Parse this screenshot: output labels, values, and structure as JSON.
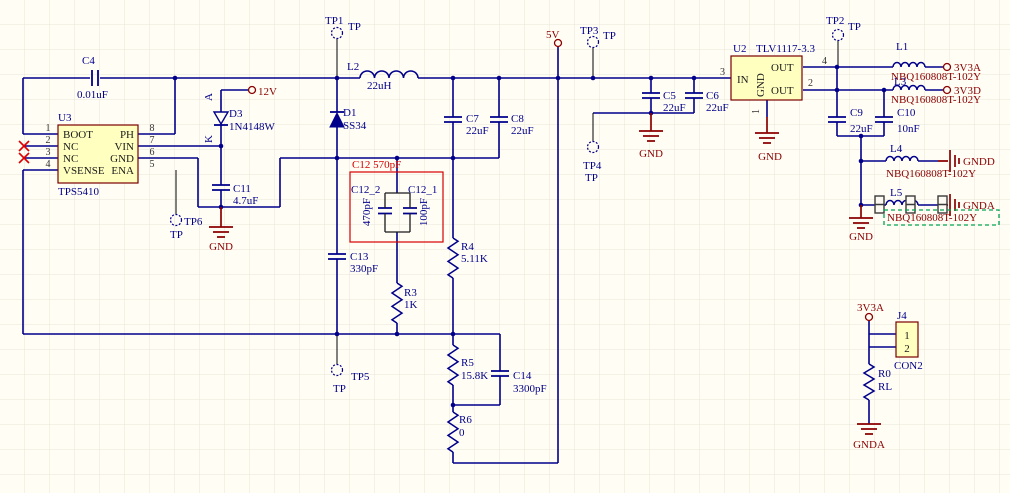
{
  "parts": {
    "U3": {
      "ref": "U3",
      "value": "TPS5410",
      "pin_names": [
        "BOOT",
        "NC",
        "NC",
        "VSENSE",
        "PH",
        "VIN",
        "GND",
        "ENA"
      ],
      "pin_numbers": [
        "1",
        "2",
        "3",
        "4",
        "8",
        "7",
        "6",
        "5"
      ]
    },
    "U2": {
      "ref": "U2",
      "value": "TLV1117-3.3",
      "pin_names": [
        "IN",
        "GND",
        "OUT",
        "OUT"
      ],
      "pin_numbers": [
        "3",
        "1",
        "4",
        "2"
      ]
    },
    "C4": {
      "ref": "C4",
      "value": "0.01uF"
    },
    "C5": {
      "ref": "C5",
      "value": "22uF"
    },
    "C6": {
      "ref": "C6",
      "value": "22uF"
    },
    "C7": {
      "ref": "C7",
      "value": "22uF"
    },
    "C8": {
      "ref": "C8",
      "value": "22uF"
    },
    "C9": {
      "ref": "C9",
      "value": "22uF"
    },
    "C10": {
      "ref": "C10",
      "value": "10nF"
    },
    "C11": {
      "ref": "C11",
      "value": "4.7uF"
    },
    "C12": {
      "note": "C12 570pF",
      "left": {
        "ref": "C12_2",
        "value": "470pF"
      },
      "right": {
        "ref": "C12_1",
        "value": "100pF"
      }
    },
    "C13": {
      "ref": "C13",
      "value": "330pF"
    },
    "C14": {
      "ref": "C14",
      "value": "3300pF"
    },
    "R0": {
      "ref": "R0",
      "value": "RL"
    },
    "R3": {
      "ref": "R3",
      "value": "1K"
    },
    "R4": {
      "ref": "R4",
      "value": "5.11K"
    },
    "R5": {
      "ref": "R5",
      "value": "15.8K"
    },
    "R6": {
      "ref": "R6",
      "value": "0"
    },
    "L1": {
      "ref": "L1",
      "value": "NBQ160808T-102Y"
    },
    "L2": {
      "ref": "L2",
      "value": "22uH"
    },
    "L3": {
      "ref": "L3",
      "value": "NBQ160808T-102Y"
    },
    "L4": {
      "ref": "L4",
      "value": "NBQ160808T-102Y"
    },
    "L5": {
      "ref": "L5",
      "value": "NBQ160808T-102Y"
    },
    "D1": {
      "ref": "D1",
      "value": "SS34"
    },
    "D3": {
      "ref": "D3",
      "value": "1N4148W",
      "anode": "A",
      "cathode": "K"
    },
    "J4": {
      "ref": "J4",
      "value": "CON2",
      "pin_numbers": [
        "1",
        "2"
      ]
    }
  },
  "nets": {
    "v12": "12V",
    "v5": "5V",
    "v3a": "3V3A",
    "v3d": "3V3D",
    "gnd": "GND",
    "gndd": "GNDD",
    "gnda": "GNDA"
  },
  "testpoints": {
    "tp1": "TP1",
    "tp2": "TP2",
    "tp3": "TP3",
    "tp4": "TP4",
    "tp5": "TP5",
    "tp6": "TP6",
    "type_label": "TP"
  },
  "colors": {
    "wire": "#00008B",
    "power_net": "#8B0000",
    "highlight_box": "#D40000",
    "selection_green": "#00A650",
    "component_fill": "#FFFFC0",
    "component_border": "#7A0000"
  }
}
